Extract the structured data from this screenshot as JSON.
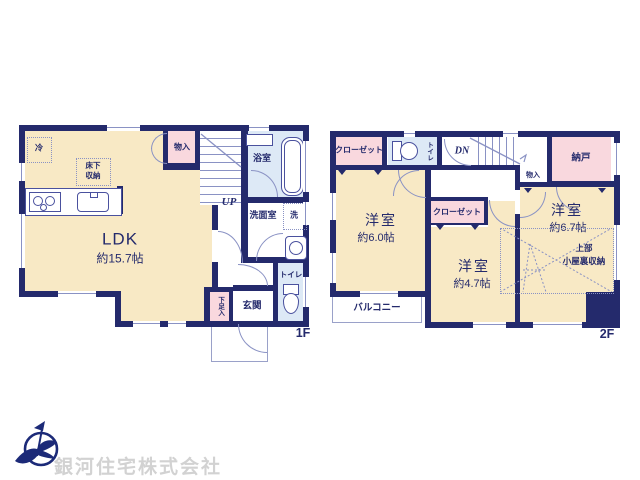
{
  "floors": {
    "f1": {
      "tag": "1F",
      "up": "UP",
      "ldk": {
        "name": "LDK",
        "size": "約15.7帖"
      },
      "monoire": "物入",
      "bath": "浴室",
      "wash": "洗面室",
      "laundry": "洗",
      "toilet": "トイレ",
      "genkan": "玄関",
      "shoe": "下足入",
      "fridge": "冷",
      "underfloor1": "床下",
      "underfloor2": "収納"
    },
    "f2": {
      "tag": "2F",
      "dn": "DN",
      "closet1": "クローゼット",
      "closet2": "クローゼット",
      "toilet": "トイレ",
      "nando": "納戸",
      "monoire": "物入",
      "room1": {
        "name": "洋室",
        "size": "約6.0帖"
      },
      "room2": {
        "name": "洋室",
        "size": "約4.7帖"
      },
      "room3": {
        "name": "洋室",
        "size": "約6.7帖"
      },
      "attic1": "上部",
      "attic2": "小屋裏収納",
      "balcony": "バルコニー"
    }
  },
  "footer": {
    "company": "銀河住宅株式会社"
  },
  "colors": {
    "wall": "#242a6c",
    "room_cream": "#f8e9c5",
    "closet_pink": "#f9d8de",
    "wet_blue": "#dde9f6",
    "thin_line": "#8a92c4",
    "logo_navy": "#1c2a78",
    "watermark_gray": "#d2d2d2"
  }
}
